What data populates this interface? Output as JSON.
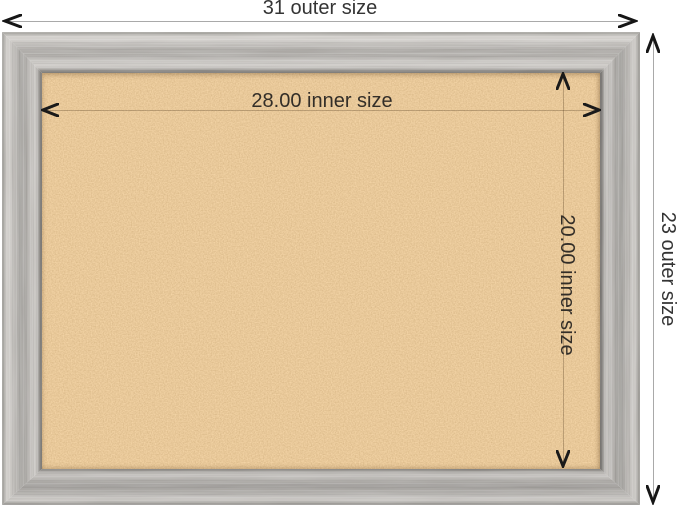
{
  "diagram": {
    "outer_width": {
      "label": "31 outer size"
    },
    "outer_height": {
      "label": "23 outer size"
    },
    "inner_width": {
      "label": "28.00 inner size"
    },
    "inner_height": {
      "label": "20.00 inner size"
    }
  },
  "colors": {
    "background": "#ffffff",
    "cork_base": "#cf9452",
    "cork_dark_speck": "#a87338",
    "cork_light_speck": "#f5b56b",
    "frame_light_gray": "#ccc9c5",
    "frame_mid_gray": "#a5a29e",
    "frame_edge_dark": "#807d79",
    "outer_dimension_line": "#a9a9a9",
    "inner_dimension_line": "rgba(61,40,16,0.28)",
    "arrow": "#161616",
    "label_text": "#343434"
  },
  "icons": {
    "chevron_left": "dimension arrow pointing left",
    "chevron_right": "dimension arrow pointing right",
    "chevron_up": "dimension arrow pointing up",
    "chevron_down": "dimension arrow pointing down"
  }
}
